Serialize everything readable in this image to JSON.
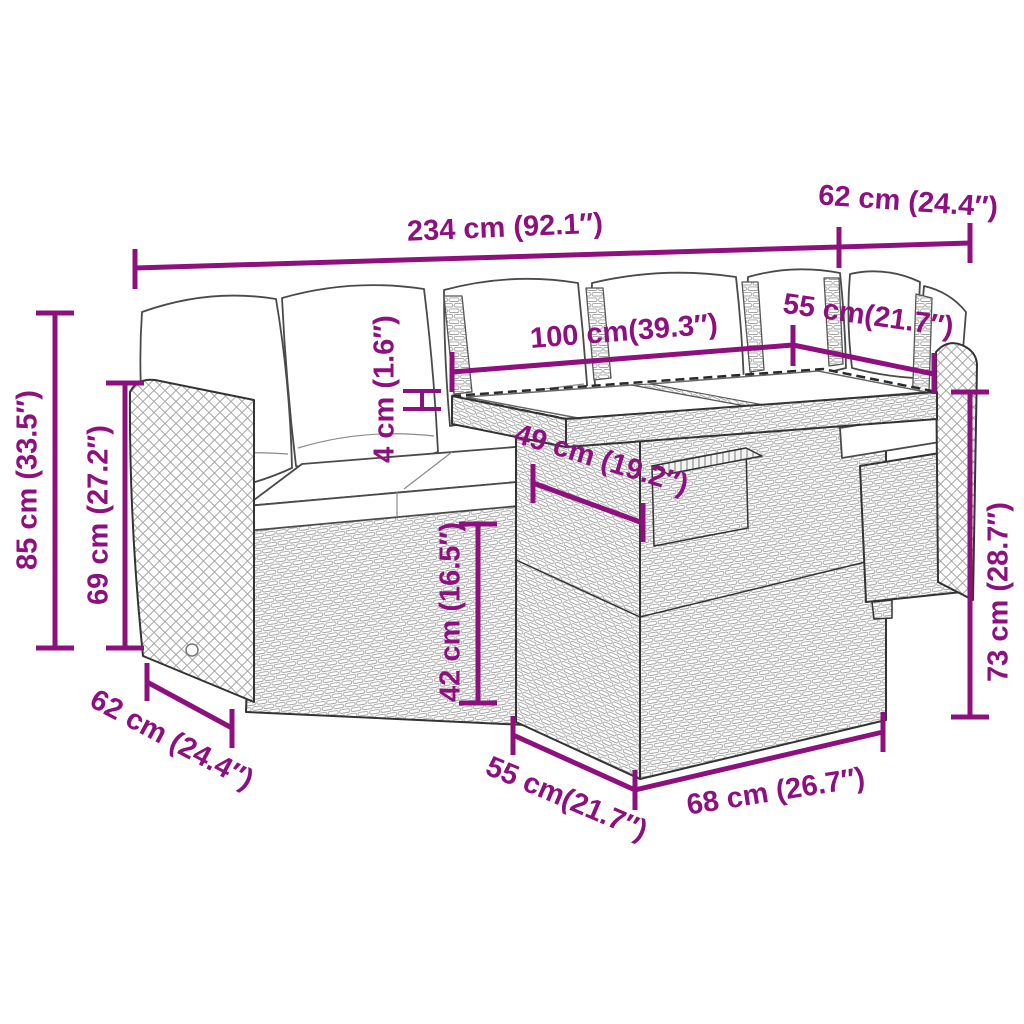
{
  "colors": {
    "dimension": "#8E107E",
    "outline": "#333333",
    "rattan_weave": "#a3a3a3",
    "cushion": "#ffffff",
    "background": "#ffffff"
  },
  "labels": {
    "total_width": "234 cm (92.1″)",
    "corner_depth_top": "62 cm (24.4″)",
    "table_length": "100 cm(39.3″)",
    "table_width_top": "55 cm(21.7″)",
    "glass_thickness": "4 cm (1.6″)",
    "total_height": "85 cm (33.5″)",
    "backrest_height": "69 cm (27.2″)",
    "stool_depth": "49 cm (19.2″)",
    "seat_height": "42 cm (16.5″)",
    "table_height": "73 cm (28.7″)",
    "side_depth_bottom": "62 cm (24.4″)",
    "base_depth_bottom": "55 cm(21.7″)",
    "base_width_bottom": "68 cm (26.7″)"
  }
}
